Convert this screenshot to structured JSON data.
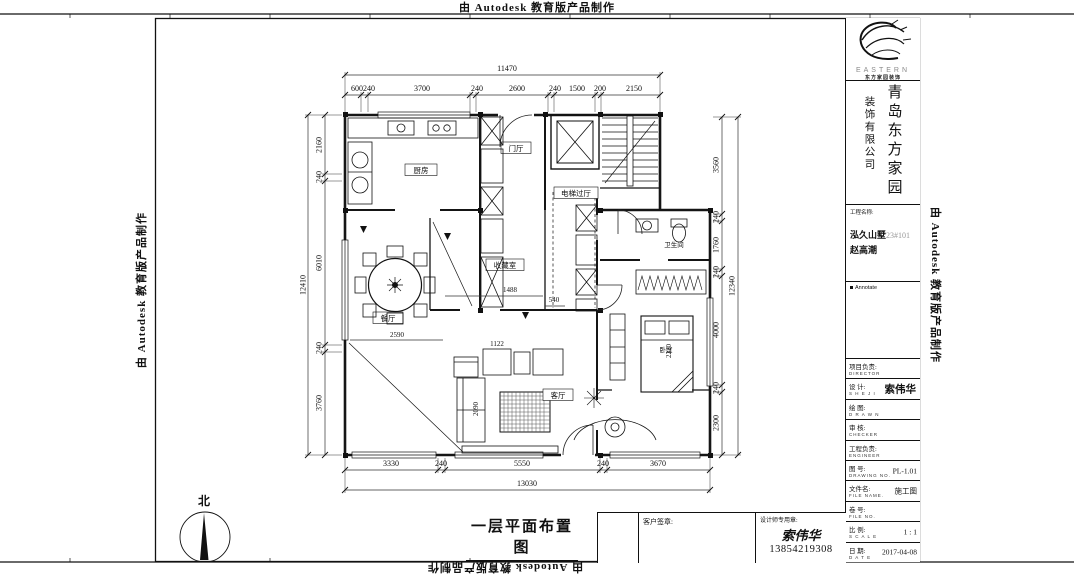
{
  "stamp": {
    "text": "由 Autodesk 教育版产品制作"
  },
  "title_block": {
    "brand": "EASTERN",
    "brand_sub": "东方家园装饰",
    "company_main": "青岛东方家园",
    "company_sub": "装饰有限公司",
    "project_label": "工程名称:",
    "project_name": "泓久山墅",
    "project_no": "23#101",
    "project_client": "赵高潮",
    "annotate": "Annotate",
    "rows": [
      {
        "label": "项目负责:",
        "sub": "DIRECTOR",
        "value": ""
      },
      {
        "label": "设 计:",
        "sub": "S H E J I",
        "value": "索伟华"
      },
      {
        "label": "绘 图:",
        "sub": "D R A W N",
        "value": ""
      },
      {
        "label": "审 核:",
        "sub": "CHECKER",
        "value": ""
      },
      {
        "label": "工程负责:",
        "sub": "ENGINEER",
        "value": ""
      },
      {
        "label": "图 号:",
        "sub": "DRAWING NO.",
        "value": "PL-1.01"
      },
      {
        "label": "文件名:",
        "sub": "FILE NAME.",
        "value": "施工图"
      },
      {
        "label": "卷 号:",
        "sub": "FILE NO.",
        "value": ""
      },
      {
        "label": "比 例:",
        "sub": "S C A L E",
        "value": "1 : 1"
      },
      {
        "label": "日 期:",
        "sub": "D A T E",
        "value": "2017-04-08"
      }
    ]
  },
  "plan": {
    "rooms": {
      "kitchen": "厨房",
      "foyer": "门厅",
      "elevator_hall": "电梯过厅",
      "collection": "收藏室",
      "dining": "餐厅",
      "living": "客厅",
      "bedroom": "卧室",
      "bathroom": "卫生间"
    },
    "dims": {
      "top_total": "11470",
      "top_segments": [
        "600",
        "240",
        "3700",
        "240",
        "2600",
        "240",
        "1500",
        "200",
        "2150"
      ],
      "left_total": "12410",
      "left_segments": [
        "2160",
        "240",
        "6010",
        "240",
        "3760"
      ],
      "right_total": "12340",
      "right_segments": [
        "3560",
        "240",
        "1760",
        "240",
        "4000",
        "240",
        "2300"
      ],
      "bottom_total": "13030",
      "bottom_segments": [
        "3330",
        "240",
        "5550",
        "240",
        "3670"
      ],
      "inner": {
        "dining": "2590",
        "hall_a": "1488",
        "hall_b": "540",
        "sofa_a": "1122",
        "sofa_b": "2090",
        "bed": "2220"
      }
    }
  },
  "footer": {
    "drawing_title": "一层平面布置图",
    "customer_label": "客户签章:",
    "designer_label": "设计师专用章:",
    "designer_name": "索伟华",
    "designer_phone": "13854219308",
    "north_label": "北"
  }
}
